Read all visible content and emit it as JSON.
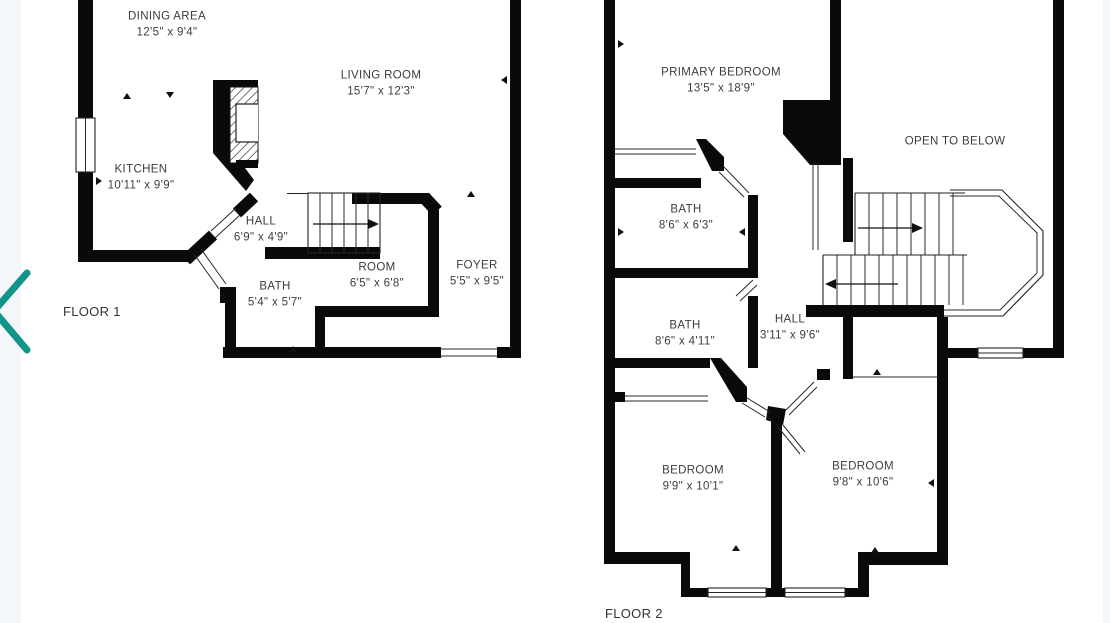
{
  "colors": {
    "background": "#ffffff",
    "side_strip": "#f3f7fb",
    "wall": "#0a0a0a",
    "label_text": "#3d3d3d",
    "accent_chevron": "#12948a"
  },
  "carousel": {
    "prev_icon": "chevron-left"
  },
  "floor1": {
    "name": "FLOOR 1",
    "rooms": [
      {
        "label": "DINING AREA",
        "dims": "12'5\" x 9'4\""
      },
      {
        "label": "LIVING ROOM",
        "dims": "15'7\" x 12'3\""
      },
      {
        "label": "KITCHEN",
        "dims": "10'11\" x 9'9\""
      },
      {
        "label": "HALL",
        "dims": "6'9\" x 4'9\""
      },
      {
        "label": "BATH",
        "dims": "5'4\" x 5'7\""
      },
      {
        "label": "ROOM",
        "dims": "6'5\" x 6'8\""
      },
      {
        "label": "FOYER",
        "dims": "5'5\" x 9'5\""
      }
    ]
  },
  "floor2": {
    "name": "FLOOR 2",
    "rooms": [
      {
        "label": "PRIMARY BEDROOM",
        "dims": "13'5\" x 18'9\""
      },
      {
        "label": "OPEN TO BELOW",
        "dims": ""
      },
      {
        "label": "BATH",
        "dims": "8'6\" x 6'3\""
      },
      {
        "label": "BATH",
        "dims": "8'6\" x 4'11\""
      },
      {
        "label": "HALL",
        "dims": "3'11\" x 9'6\""
      },
      {
        "label": "BEDROOM",
        "dims": "9'9\" x 10'1\""
      },
      {
        "label": "BEDROOM",
        "dims": "9'8\" x 10'6\""
      }
    ]
  }
}
